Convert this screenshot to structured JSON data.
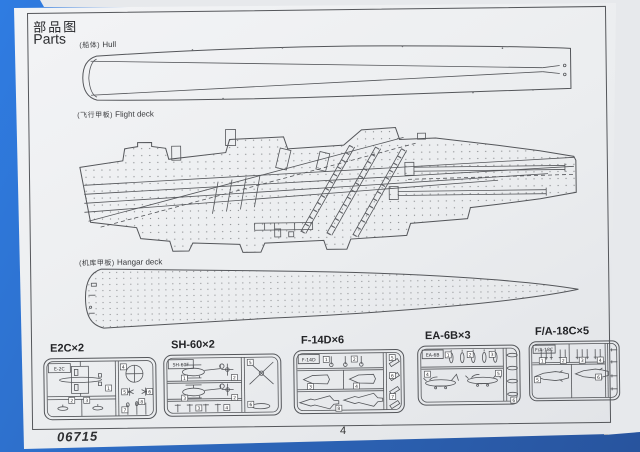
{
  "header": {
    "title_zh": "部品图",
    "title_en": "Parts"
  },
  "decks": {
    "hull": {
      "zh": "(船体)",
      "en": "Hull"
    },
    "flight": {
      "zh": "(飞行甲板)",
      "en": "Flight deck"
    },
    "hangar": {
      "zh": "(机库甲板)",
      "en": "Hangar deck"
    }
  },
  "sprues": [
    {
      "title": "E2C×2",
      "tag": "E-2C",
      "parts": [
        "1",
        "2",
        "3",
        "4",
        "5",
        "6",
        "7",
        "8"
      ]
    },
    {
      "title": "SH-60×2",
      "tag": "SH-60F",
      "parts": [
        "1",
        "2",
        "3",
        "4",
        "5",
        "6"
      ]
    },
    {
      "title": "F-14D×6",
      "tag": "F-14D",
      "parts": [
        "1",
        "2",
        "3",
        "4",
        "5",
        "6",
        "7",
        "8"
      ]
    },
    {
      "title": "EA-6B×3",
      "tag": "EA-6B",
      "parts": [
        "1",
        "2",
        "3",
        "4",
        "5",
        "6"
      ]
    },
    {
      "title": "F/A-18C×5",
      "tag": "F/A-18C",
      "parts": [
        "1",
        "2",
        "3",
        "4",
        "5",
        "6"
      ]
    }
  ],
  "footer": {
    "kit_number": "06715",
    "page_number": "4"
  },
  "colors": {
    "backdrop_blue": "#2d6fd2",
    "paper": "#eef0f2",
    "line_art": "#54565a"
  }
}
